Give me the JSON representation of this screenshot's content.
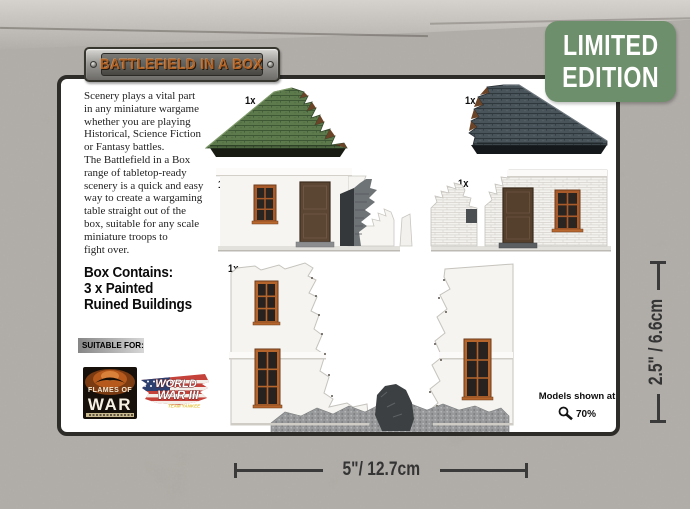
{
  "badge": {
    "line1": "LIMITED",
    "line2": "EDITION"
  },
  "banner": {
    "title": "BATTLEFIELD IN A BOX"
  },
  "card": {
    "description": "Scenery plays a vital part\nin any miniature wargame\nwhether you are playing\nHistorical, Science Fiction\nor Fantasy battles.\nThe Battlefield in a Box\nrange of tabletop-ready\nscenery is a quick and easy\nway to create a wargaming\ntable straight out of the\nbox, suitable for any scale\nminiature troops to\nfight over.",
    "box_contains": "Box Contains:\n3 x  Painted\nRuined Buildings",
    "suitable_for_label": "SUITABLE FOR:",
    "logos": {
      "flames_of_war": {
        "line1": "FLAMES OF",
        "line2": "WAR"
      },
      "world_war_iii": {
        "line1": "WORLD",
        "line2": "WAR III",
        "tagline": "TEAM YANKEE"
      }
    },
    "quantity_labels": [
      "1x",
      "1x",
      "1x",
      "1x",
      "1x"
    ],
    "models_note": {
      "prefix": "Models shown at",
      "percent": "70%"
    }
  },
  "dimensions": {
    "width": "5\"/ 12.7cm",
    "height": "2.5\" / 6.6cm"
  },
  "colors": {
    "badge_green": "#6e8f6b",
    "rust_lettering": "#b06226",
    "roof_green": "#5d7a4c",
    "roof_slate": "#49545a",
    "window_frame_orange": "#a85a2a",
    "door_brown": "#5b4533",
    "dimension_line": "#3a3a3a",
    "card_border": "#2d2c29",
    "concrete_gray": "#a29e99"
  }
}
